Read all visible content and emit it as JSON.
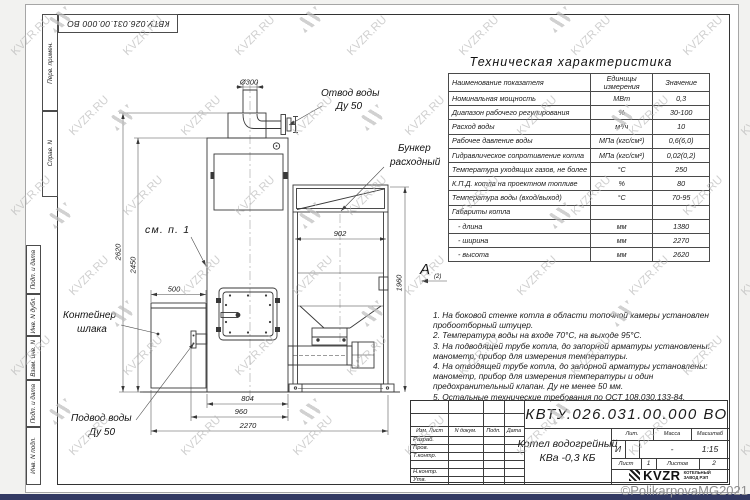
{
  "frame": {
    "designation_top": "КВТУ.026.031.00.000 ВО",
    "margin_labels": [
      "Перв. примен.",
      "Справ. N",
      "Подп. и дата",
      "Инв. N дубл.",
      "Взам. инв. N",
      "Подп. и дата",
      "Инв. N подл."
    ]
  },
  "drawing": {
    "labels": {
      "outlet1": "Отвод воды",
      "outlet2": "Ду 50",
      "bunker1": "Бункер",
      "bunker2": "расходный",
      "see_note": "см. п. 1",
      "slag1": "Контейнер",
      "slag2": "шлака",
      "inlet1": "Подвод воды",
      "inlet2": "Ду 50",
      "view_letter": "А",
      "view_index": "(2)"
    },
    "dims": {
      "chimney": "Ø300",
      "total_height": "2620",
      "body_height": "2450",
      "slag_width": "500",
      "base_width": "804",
      "mid_width": "960",
      "total_width": "2270",
      "bunker_width": "902",
      "bunker_height": "1960"
    }
  },
  "spec_table": {
    "title": "Техническая характеристика",
    "col_name": "Наименование показателя",
    "col_units": "Единицы измерения",
    "col_value": "Значение",
    "rows": [
      [
        "Номинальная мощность",
        "МВт",
        "0,3"
      ],
      [
        "Диапазон рабочего регулирования",
        "%",
        "30-100"
      ],
      [
        "Расход воды",
        "м³/ч",
        "10"
      ],
      [
        "Рабочее давление воды",
        "МПа (кгс/см²)",
        "0,6(6,0)"
      ],
      [
        "Гидравлическое сопротивление котла",
        "МПа (кгс/см²)",
        "0,02(0,2)"
      ],
      [
        "Температура уходящих газов, не более",
        "°С",
        "250"
      ],
      [
        "К.П.Д. котла на проектном топливе",
        "%",
        "80"
      ],
      [
        "Температура воды (вход/выход)",
        "°С",
        "70-95"
      ],
      [
        "Габариты котла",
        "",
        ""
      ],
      [
        "   - длина",
        "мм",
        "1380"
      ],
      [
        "   - ширина",
        "мм",
        "2270"
      ],
      [
        "   - высота",
        "мм",
        "2620"
      ]
    ]
  },
  "notes": [
    "1.  На боковой стенке котла в области топочной камеры установлен пробоотборный штуцер.",
    "2.  Температура воды на входе 70°С, на выходе 95°С.",
    "3.  На подводящей трубе котла, до запорной арматуры установлены: манометр, прибор для измерения температуры.",
    "4.  На отводящей трубе котла, до запорной арматуры установлены: манометр, прибор для измерения температуры и один предохранительный клапан. Ду не менее 50 мм.",
    "5.  Остальные технические требования по ОСТ 108.030.133-84."
  ],
  "title_block": {
    "designation": "КВТУ.026.031.00.000  ВО",
    "header_cells": [
      "Изм. Лист",
      "N докум.",
      "Подп.",
      "Дата"
    ],
    "roles": [
      "Разраб.",
      "Пров.",
      "Т.контр.",
      "Н.контр.",
      "Утв."
    ],
    "product_line1": "Котел водогрейный",
    "product_line2": "КВа -0,3  КБ",
    "lit_header": "Лит.",
    "mass_header": "Масса",
    "scale_header": "Масштаб",
    "lit_value": "И",
    "mass_value": "-",
    "scale_value": "1:15",
    "sheet_label": "Лист",
    "sheet_value": "1",
    "sheets_label": "Листов",
    "sheets_value": "2",
    "logo_text": "KVZR",
    "logo_sub1": "КОТЕЛЬНЫЙ",
    "logo_sub2": "ЗАВОД РЭП"
  },
  "watermark": {
    "text": "KVZR.RU",
    "copyright": "©PolikarpovaMG2021"
  }
}
